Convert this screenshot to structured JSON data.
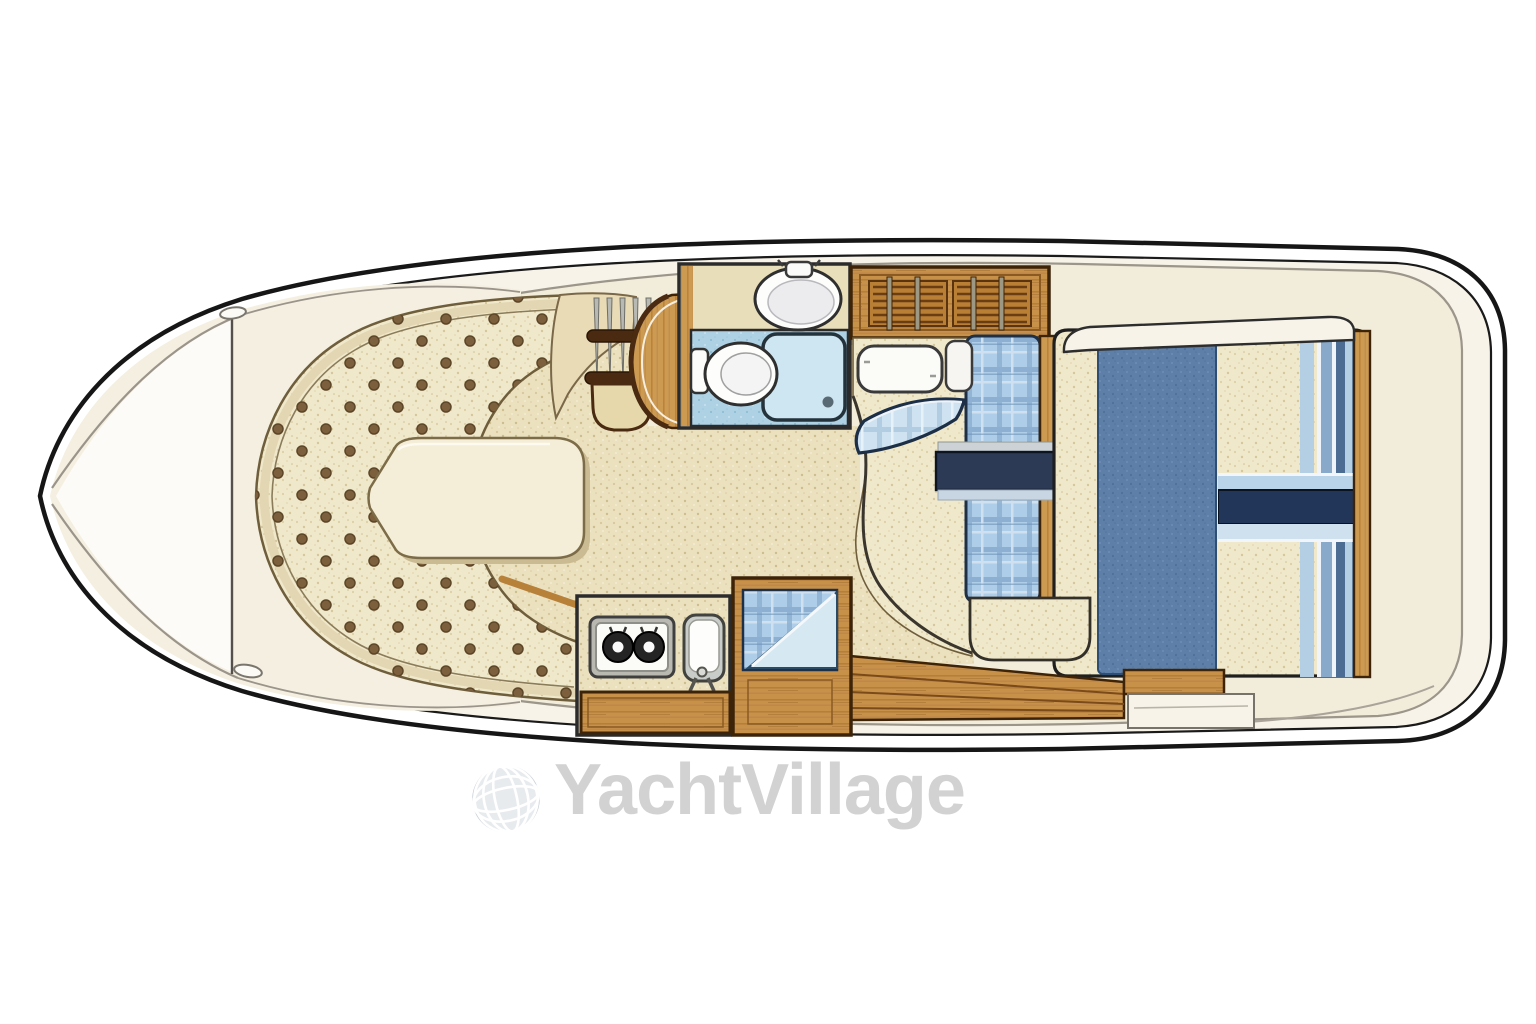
{
  "watermark": {
    "text": "YachtVillage"
  },
  "palette": {
    "hull_outline": "#161616",
    "deck_white": "#f7f3e9",
    "deck_cream": "#f2ecdb",
    "cushion_cream": "#f0e8ca",
    "button_brown": "#7c5f3c",
    "trim_tan": "#e3d6b2",
    "wood_oak": "#c8914a",
    "wood_outline": "#3d2408",
    "tile_blue": "#aed2e4",
    "shower_blue": "#cde6f2",
    "plaid_blue": "#aecde8",
    "navy": "#2c3a55",
    "denim_blue": "#5d7fa8",
    "fixture_white": "#fbfbf8",
    "watermark_gray": "#d2d2d2"
  },
  "floorplan": {
    "view": "top-down yacht interior floor plan",
    "areas": [
      {
        "id": "foredeck"
      },
      {
        "id": "v-berth-buttoned-cushions"
      },
      {
        "id": "v-berth-filler-cushion"
      },
      {
        "id": "companionway-rack-and-door"
      },
      {
        "id": "head-sink-toilet-shower"
      },
      {
        "id": "louvered-cabinet"
      },
      {
        "id": "mid-berth-plaid-bedding"
      },
      {
        "id": "galley-two-burner-stove-and-sink"
      },
      {
        "id": "quarter-berth"
      },
      {
        "id": "aft-double-berth"
      },
      {
        "id": "companionway-steps-wood-sole"
      },
      {
        "id": "stern-deck"
      }
    ]
  }
}
